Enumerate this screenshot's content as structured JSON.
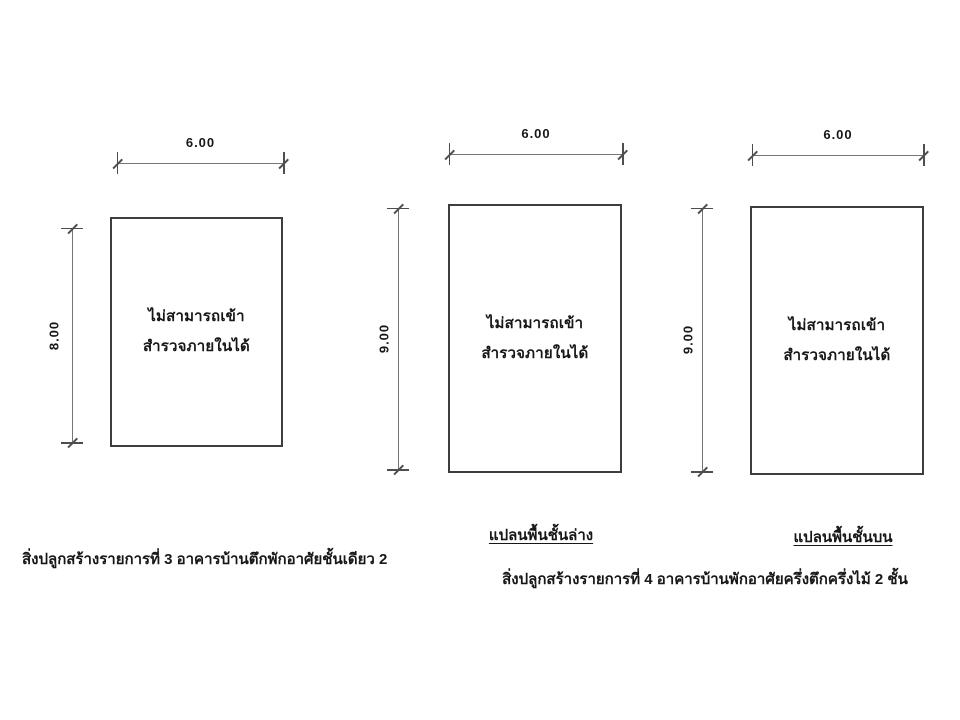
{
  "figures": [
    {
      "name": "building-item-3-plan",
      "width_dim": "6.00",
      "height_dim": "8.00",
      "note_line1": "ไม่สามารถเข้า",
      "note_line2": "สำรวจภายในได้",
      "caption": "สิ่งปลูกสร้างรายการที่ 3 อาคารบ้านตึกพักอาศัยชั้นเดียว 2"
    },
    {
      "name": "building-item-4-lower-floor-plan",
      "width_dim": "6.00",
      "height_dim": "9.00",
      "note_line1": "ไม่สามารถเข้า",
      "note_line2": "สำรวจภายในได้",
      "plan_label": "แปลนพื้นชั้นล่าง"
    },
    {
      "name": "building-item-4-upper-floor-plan",
      "width_dim": "6.00",
      "height_dim": "9.00",
      "note_line1": "ไม่สามารถเข้า",
      "note_line2": "สำรวจภายในได้",
      "plan_label": "แปลนพื้นชั้นบน"
    }
  ],
  "captions": {
    "item4": "สิ่งปลูกสร้างรายการที่ 4 อาคารบ้านพักอาศัยครึ่งตึกครึ่งไม้ 2 ชั้น"
  },
  "colors": {
    "line": "#757575",
    "tick": "#4e4e4e",
    "outline": "#3d3d3d",
    "text": "#171717",
    "bg": "#ffffff"
  }
}
